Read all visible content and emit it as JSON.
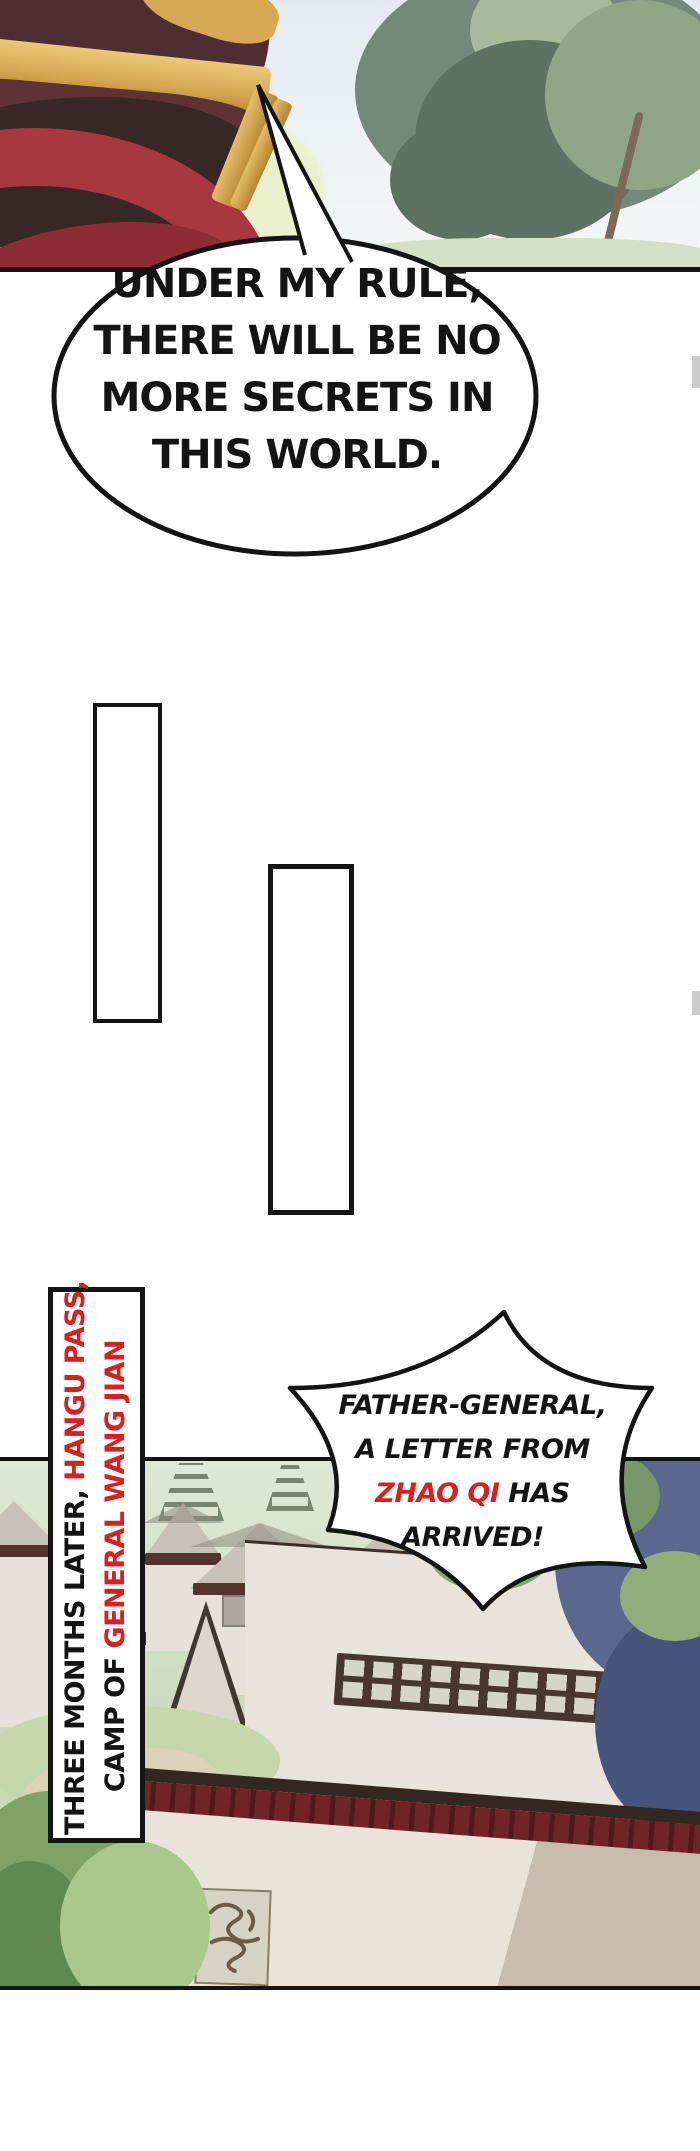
{
  "page": {
    "kind": "webtoon comic page",
    "width": 700,
    "height": 2151
  },
  "speech_bubble": {
    "lines": [
      "UNDER MY RULE,",
      "THERE WILL BE NO",
      "MORE SECRETS IN",
      "THIS WORLD."
    ]
  },
  "shout_bubble": {
    "line1": "FATHER-GENERAL,",
    "line2": "A LETTER FROM",
    "line3_red": "ZHAO QI",
    "line3_rest": " HAS",
    "line4": "ARRIVED!"
  },
  "caption": {
    "line1_black": "THREE MONTHS LATER, ",
    "line1_red": "HANGU PASS,",
    "line2_black": "CAMP OF ",
    "line2_red": "GENERAL WANG JIAN"
  },
  "colors": {
    "ink": "#141414",
    "red-text": "#d82020",
    "paper": "#ffffff",
    "sky-top": "#e3ebf1",
    "sky-bottom": "#f2f5f6",
    "tree-a": "#74897b",
    "tree-b": "#5d7263",
    "tree-c": "#90a687",
    "tree-d": "#a7bb9a",
    "ground-top": "#d3dfc6",
    "helmet": "#4f2e33",
    "helmet-dark": "#382823",
    "gold": "#d8a954",
    "gold-dark": "#b5832f",
    "scarf": "#a8383f",
    "scarf-dark": "#8d2c34",
    "field-top": "#e0e8d6",
    "field-bottom": "#c9dab8",
    "hill": "#c6d7ae",
    "sky-right": "#c9d0d8",
    "tower": "#59634f",
    "tent-wall": "#e7e2d9",
    "tent-roof": "#c7c2b8",
    "tent-roof-dark": "#8f8a80",
    "tent-trim": "#54332d",
    "emblem-grey": "#a09a90",
    "fence-dark": "#2e2a24",
    "fence-light": "#e8e4da",
    "canvas": "#e9e4db",
    "band": "#463830",
    "slat": "#d9d4c8",
    "beam": "#33271f",
    "valance": "#6f2527",
    "valance-dark": "#51191c",
    "fg-wall": "#eae4d8",
    "grass-a": "#7da465",
    "grass-b": "#5e8a50",
    "grass-c": "#a9c98c",
    "path-tan": "#dbd2b8",
    "fol-blue": "#5a6890",
    "fol-blue-dark": "#46547c",
    "fol-green": "#76986a",
    "emblem-bg": "#d8d2c4",
    "emblem-ink": "#6b5c49",
    "tab": "#cbcbcb"
  }
}
